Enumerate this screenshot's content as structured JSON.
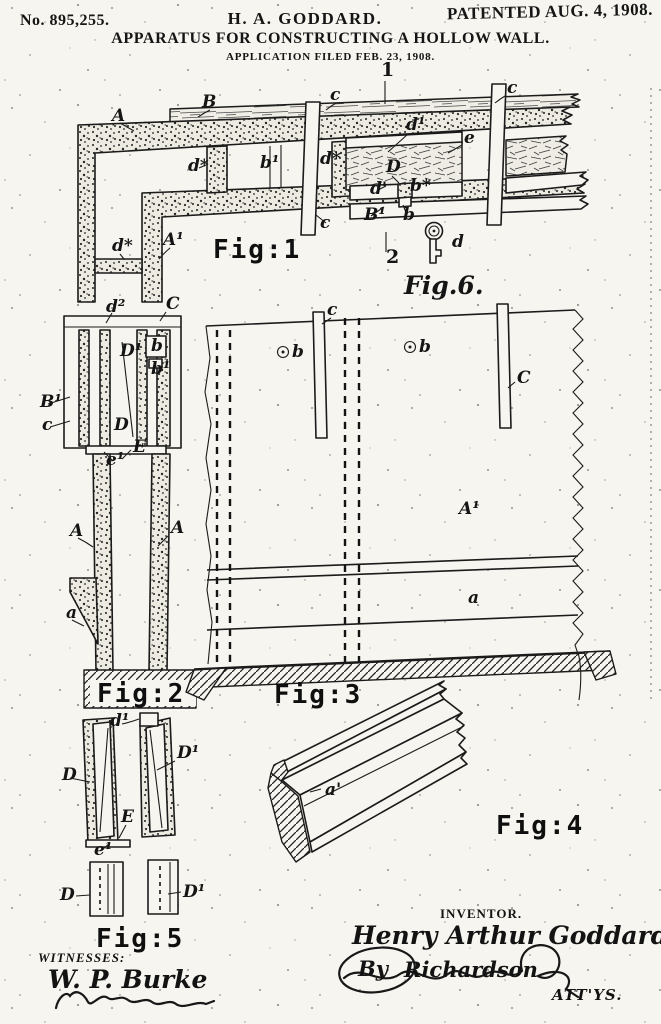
{
  "header": {
    "patent_number": "No. 895,255.",
    "inventor_short": "H. A. GODDARD.",
    "patented": "PATENTED AUG. 4, 1908.",
    "title": "APPARATUS FOR CONSTRUCTING A HOLLOW WALL.",
    "application": "APPLICATION FILED FEB. 23, 1908."
  },
  "figures": {
    "fig1": {
      "caption": "Fig:1",
      "refs": [
        {
          "t": "A",
          "x": 112,
          "y": 121
        },
        {
          "t": "B",
          "x": 202,
          "y": 107
        },
        {
          "t": "1",
          "x": 381,
          "y": 76,
          "cls": "num"
        },
        {
          "t": "c",
          "x": 330,
          "y": 100
        },
        {
          "t": "c",
          "x": 320,
          "y": 228
        },
        {
          "t": "c",
          "x": 507,
          "y": 93
        },
        {
          "t": "d*",
          "x": 188,
          "y": 171
        },
        {
          "t": "b¹",
          "x": 260,
          "y": 168
        },
        {
          "t": "d*",
          "x": 320,
          "y": 164
        },
        {
          "t": "d¹",
          "x": 406,
          "y": 130
        },
        {
          "t": "e",
          "x": 464,
          "y": 143
        },
        {
          "t": "D",
          "x": 386,
          "y": 172
        },
        {
          "t": "d'",
          "x": 370,
          "y": 194
        },
        {
          "t": "b*",
          "x": 410,
          "y": 191
        },
        {
          "t": "B¹",
          "x": 364,
          "y": 220
        },
        {
          "t": "b",
          "x": 403,
          "y": 220
        },
        {
          "t": "A¹",
          "x": 163,
          "y": 245
        },
        {
          "t": "d*",
          "x": 112,
          "y": 251
        },
        {
          "t": "2",
          "x": 386,
          "y": 263,
          "cls": "num"
        },
        {
          "t": "Fig:1",
          "x": 213,
          "y": 258,
          "cls": "cap"
        }
      ]
    },
    "fig6": {
      "caption": "Fig.6.",
      "refs": [
        {
          "t": "d",
          "x": 452,
          "y": 247
        },
        {
          "t": "Fig.6.",
          "x": 404,
          "y": 294,
          "cls": "script"
        }
      ]
    },
    "fig2": {
      "caption": "Fig:2",
      "refs": [
        {
          "t": "d²",
          "x": 106,
          "y": 312
        },
        {
          "t": "C",
          "x": 166,
          "y": 309
        },
        {
          "t": "D¹",
          "x": 120,
          "y": 356
        },
        {
          "t": "b",
          "x": 151,
          "y": 351
        },
        {
          "t": "b¹",
          "x": 151,
          "y": 374
        },
        {
          "t": "B¹",
          "x": 40,
          "y": 407
        },
        {
          "t": "c",
          "x": 42,
          "y": 430
        },
        {
          "t": "D",
          "x": 114,
          "y": 430
        },
        {
          "t": "E",
          "x": 133,
          "y": 452
        },
        {
          "t": "e¹",
          "x": 106,
          "y": 465
        },
        {
          "t": "A",
          "x": 70,
          "y": 536
        },
        {
          "t": "A",
          "x": 171,
          "y": 533
        },
        {
          "t": "a",
          "x": 66,
          "y": 618
        },
        {
          "t": "Fig:2",
          "x": 97,
          "y": 702,
          "cls": "cap"
        }
      ]
    },
    "fig3": {
      "caption": "Fig:3",
      "refs": [
        {
          "t": "c",
          "x": 327,
          "y": 315
        },
        {
          "t": "b",
          "x": 292,
          "y": 357
        },
        {
          "t": "b",
          "x": 419,
          "y": 352
        },
        {
          "t": "C",
          "x": 517,
          "y": 383
        },
        {
          "t": "A¹",
          "x": 459,
          "y": 514
        },
        {
          "t": "a",
          "x": 468,
          "y": 603
        },
        {
          "t": "Fig:3",
          "x": 274,
          "y": 703,
          "cls": "cap"
        }
      ]
    },
    "fig4": {
      "caption": "Fig:4",
      "refs": [
        {
          "t": "a'",
          "x": 325,
          "y": 795
        },
        {
          "t": "Fig:4",
          "x": 496,
          "y": 834,
          "cls": "cap"
        }
      ]
    },
    "wedges": {
      "refs": [
        {
          "t": "d¹",
          "x": 110,
          "y": 726
        },
        {
          "t": "D¹",
          "x": 177,
          "y": 758
        },
        {
          "t": "D",
          "x": 62,
          "y": 780
        },
        {
          "t": "E",
          "x": 121,
          "y": 822
        },
        {
          "t": "e¹",
          "x": 94,
          "y": 855
        }
      ]
    },
    "fig5": {
      "caption": "Fig:5",
      "refs": [
        {
          "t": "D",
          "x": 60,
          "y": 900
        },
        {
          "t": "D¹",
          "x": 183,
          "y": 897
        },
        {
          "t": "Fig:5",
          "x": 96,
          "y": 947,
          "cls": "cap"
        }
      ]
    }
  },
  "footer": {
    "witnesses_label": "WITNESSES:",
    "witness_signature": "W. P. Burke",
    "inventor_label": "INVENTOR.",
    "inventor_signature": "Henry Arthur Goddard",
    "attorney_by": "By",
    "attorney_signature": "Richardson",
    "attorneys_label": "ATT'YS."
  }
}
